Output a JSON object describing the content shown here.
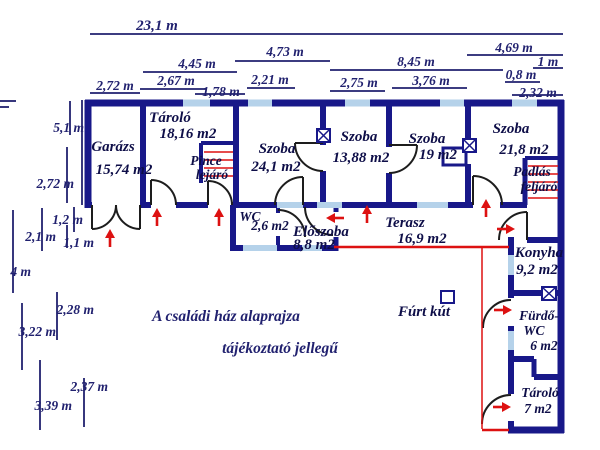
{
  "captions": {
    "line1": "A családi ház alaprajza",
    "line2": "tájékoztató jellegű"
  },
  "well": {
    "label": "Fúrt kút"
  },
  "colors": {
    "wall": "#181889",
    "window": "#b5d2ea",
    "red": "#dd1111",
    "dim": "#21216f",
    "room_text": "#0e0e48"
  },
  "rooms": {
    "garage": {
      "name": "Garázs",
      "area": "15,74 m2"
    },
    "storage_main": {
      "name": "Tároló",
      "area": "18,16 m2"
    },
    "cellar_stairs": {
      "name_line1": "Pince",
      "name_line2": "lejáró"
    },
    "room_a": {
      "name": "Szoba",
      "area": "24,1 m2"
    },
    "room_b": {
      "name": "Szoba",
      "area": "13,88 m2"
    },
    "room_c": {
      "name": "Szoba",
      "area": "19 m2"
    },
    "room_d": {
      "name": "Szoba",
      "area": "21,8 m2"
    },
    "attic_stairs": {
      "name_line1": "Padlás",
      "name_line2": "feljáró"
    },
    "wc": {
      "name": "WC",
      "area": "2,6 m2"
    },
    "hallway": {
      "name": "Előszoba",
      "area": "8,8 m2"
    },
    "terrace": {
      "name": "Terasz",
      "area": "16,9 m2"
    },
    "kitchen": {
      "name": "Konyha",
      "area": "9,2 m2"
    },
    "bathroom": {
      "name_line1": "Fürdő-",
      "name_line2": "WC",
      "area": "6 m2"
    },
    "storage_small": {
      "name": "Tároló",
      "area": "7 m2"
    }
  },
  "dimensions": {
    "top": {
      "t_23_1": "23,1 m",
      "t_4_45": "4,45 m",
      "t_4_73": "4,73 m",
      "t_2_67": "2,67 m",
      "t_2_21": "2,21 m",
      "t_2_72": "2,72 m",
      "t_1_78": "1,78 m",
      "t_8_45": "8,45 m",
      "t_2_75": "2,75 m",
      "t_3_76": "3,76 m",
      "t_4_69": "4,69 m",
      "t_1": "1 m",
      "t_0_8": "0,8 m",
      "t_2_32": "2,32 m"
    },
    "left": {
      "l_5_1": "5,1 m",
      "l_2_72": "2,72 m",
      "l_1_2": "1,2 m",
      "l_2_1": "2,1 m",
      "l_1_1": "1,1 m",
      "l_4": "4 m",
      "l_2_28": "2,28 m",
      "l_3_22": "3,22 m",
      "l_2_37": "2,37 m",
      "l_3_39": "3,39 m"
    }
  }
}
